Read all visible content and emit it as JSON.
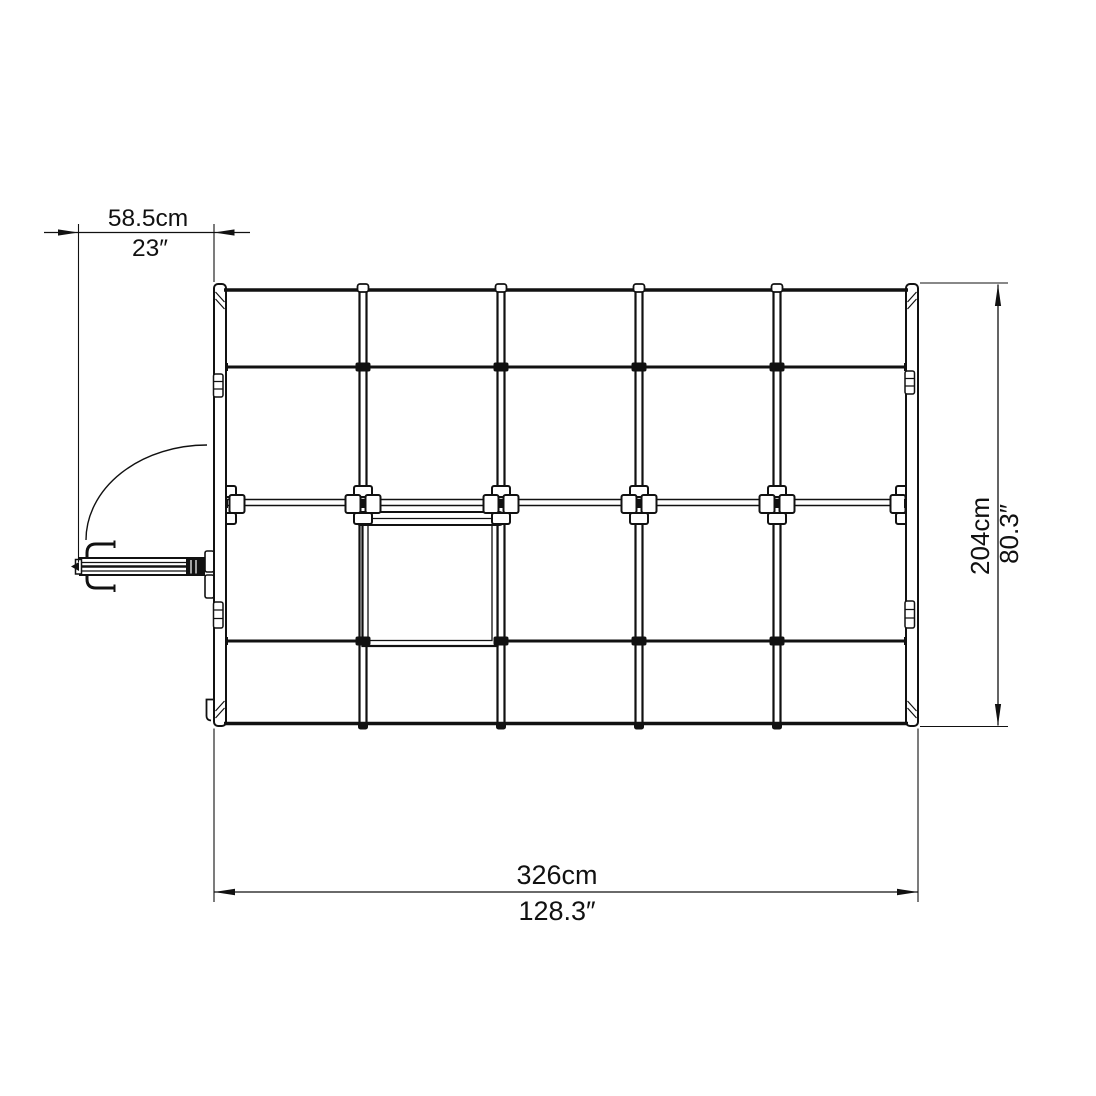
{
  "drawing": {
    "background_color": "#ffffff",
    "line_color": "#111111"
  },
  "dimensions": {
    "door_projection": {
      "metric": "58.5cm",
      "imperial": "23″"
    },
    "length": {
      "metric": "326cm",
      "imperial": "128.3″"
    },
    "depth": {
      "metric": "204cm",
      "imperial": "80.3″"
    }
  }
}
